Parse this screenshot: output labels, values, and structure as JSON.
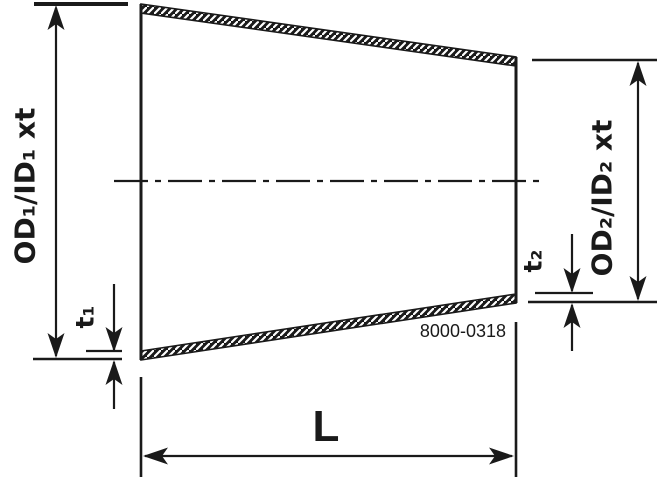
{
  "colors": {
    "ink": "#1a1a1a",
    "paper": "#ffffff"
  },
  "diagram": {
    "labels": {
      "od1": "OD₁/ID₁ xt",
      "t1": "t₁",
      "od2": "OD₂/ID₂ xt",
      "t2": "t₂",
      "length": "L",
      "drawing_number": "8000-0318"
    }
  }
}
